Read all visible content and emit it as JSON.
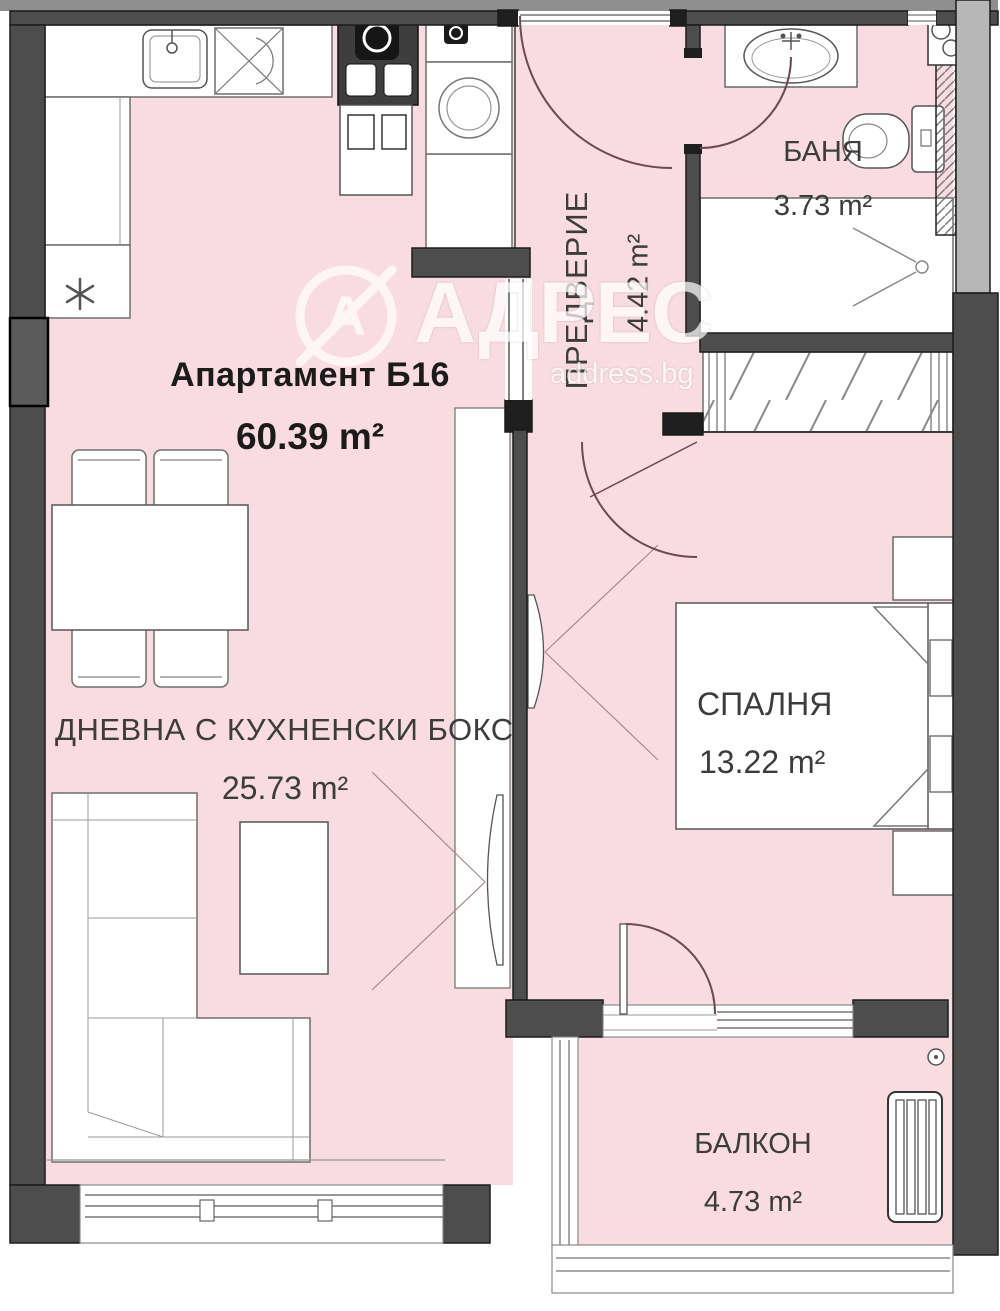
{
  "plan": {
    "title": "Апартамент Б16",
    "total_area": "60.39 m²",
    "rooms": [
      {
        "id": "living",
        "name": "ДНЕВНА С КУХНЕНСКИ БОКС",
        "area": "25.73 m²"
      },
      {
        "id": "bedroom",
        "name": "СПАЛНЯ",
        "area": "13.22 m²"
      },
      {
        "id": "bathroom",
        "name": "БАНЯ",
        "area": "3.73 m²"
      },
      {
        "id": "hallway",
        "name": "ПРЕДВЕРИЕ",
        "area": "4.42 m²"
      },
      {
        "id": "balcony",
        "name": "БАЛКОН",
        "area": "4.73 m²"
      }
    ],
    "watermark": {
      "brand": "АДРЕС",
      "domain": "address.bg",
      "logo_letter": "А"
    },
    "icons": {
      "fridge": "asterisk",
      "shower": "shower-head",
      "washer": "drum-circle"
    },
    "colors": {
      "wall": "#4d4d4d",
      "wall_outline": "#1c1c1c",
      "room_fill": "#f8dce1",
      "furniture_line": "#6f6f6f",
      "door_arc": "#6e4a50",
      "label_text": "#3c3c3c",
      "title_text": "#1b1b1b",
      "outer_strip": "#8f8f8f",
      "neighbor_wall": "#b7b7b7",
      "watermark": "#ffffff"
    }
  }
}
